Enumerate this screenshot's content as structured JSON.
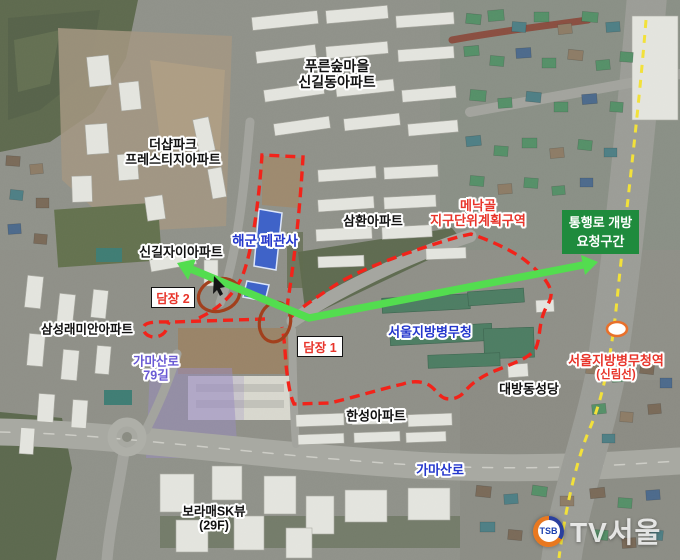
{
  "labels": {
    "pureun1": "푸른숲마을",
    "pureun2": "신길동아파트",
    "thesharp1": "더샵파크",
    "thesharp2": "프레스티지아파트",
    "menakgol1": "메낙골",
    "menakgol2": "지구단위계획구역",
    "greenbox1": "통행로 개방",
    "greenbox2": "요청구간",
    "navy": "해군 폐관사",
    "samhwan": "삼환아파트",
    "singil_xi": "신길자이아파트",
    "wall2": "담장 2",
    "raemian": "삼성래미안아파트",
    "gamasan79_1": "가마산로",
    "gamasan79_2": "79길",
    "wall1": "담장 1",
    "mma": "서울지방병무청",
    "cathedral": "대방동성당",
    "station1": "서울지방병무청역",
    "station2": "(신림선)",
    "hanseong": "한성아파트",
    "gamasan": "가마산로",
    "boramae1": "보라매SK뷰",
    "boramae2": "(29F)"
  },
  "watermark": {
    "badge": "TSB",
    "name": "TV서울"
  },
  "colors": {
    "boundary_red": "#f2231a",
    "circle_red": "#a2401d",
    "arrow_green": "#53dd4f",
    "box_green": "#1f8b3d",
    "label_blue": "#2336cc",
    "label_red": "#e8342a",
    "label_violet": "#6a5ad4",
    "rail_yellow": "#f2e13a",
    "station_ring": "#e8702b",
    "highlight_blue": "#3f63c8"
  }
}
